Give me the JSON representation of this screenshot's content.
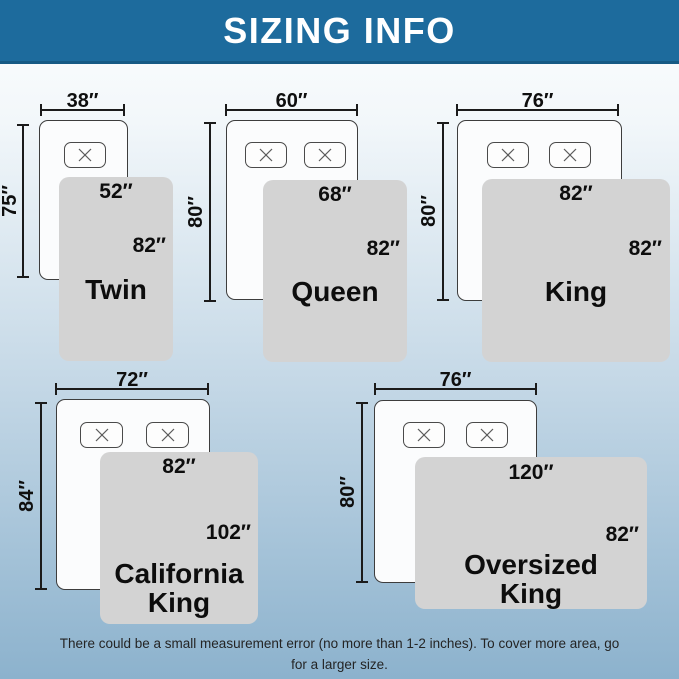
{
  "header": {
    "title": "SIZING INFO"
  },
  "diagram": {
    "sections": [
      {
        "name": "Twin",
        "bed_width": "38″",
        "bed_length": "75″",
        "blanket_width": "52″",
        "blanket_length": "82″",
        "pillow_count": 1
      },
      {
        "name": "Queen",
        "bed_width": "60″",
        "bed_length": "80″",
        "blanket_width": "68″",
        "blanket_length": "82″",
        "pillow_count": 2
      },
      {
        "name": "King",
        "bed_width": "76″",
        "bed_length": "80″",
        "blanket_width": "82″",
        "blanket_length": "82″",
        "pillow_count": 2
      },
      {
        "name": "California King",
        "bed_width": "72″",
        "bed_length": "84″",
        "blanket_width": "82″",
        "blanket_length": "102″",
        "pillow_count": 2
      },
      {
        "name": "Oversized King",
        "bed_width": "76″",
        "bed_length": "80″",
        "blanket_width": "120″",
        "blanket_length": "82″",
        "pillow_count": 2
      }
    ]
  },
  "footer": {
    "note_line1": "There could be a small measurement error (no more than 1-2 inches). To cover more area, go",
    "note_line2": "for a larger size."
  },
  "colors": {
    "header_bg": "#1d6b9d",
    "header_border": "#175a84",
    "blanket": "#d3d3d3",
    "bed_border": "#3d3d3d",
    "dim": "#1b1b1b",
    "background_top": "#fefefe",
    "background_mid": "#c6d9e7",
    "background_bottom": "#8cb2cd"
  }
}
